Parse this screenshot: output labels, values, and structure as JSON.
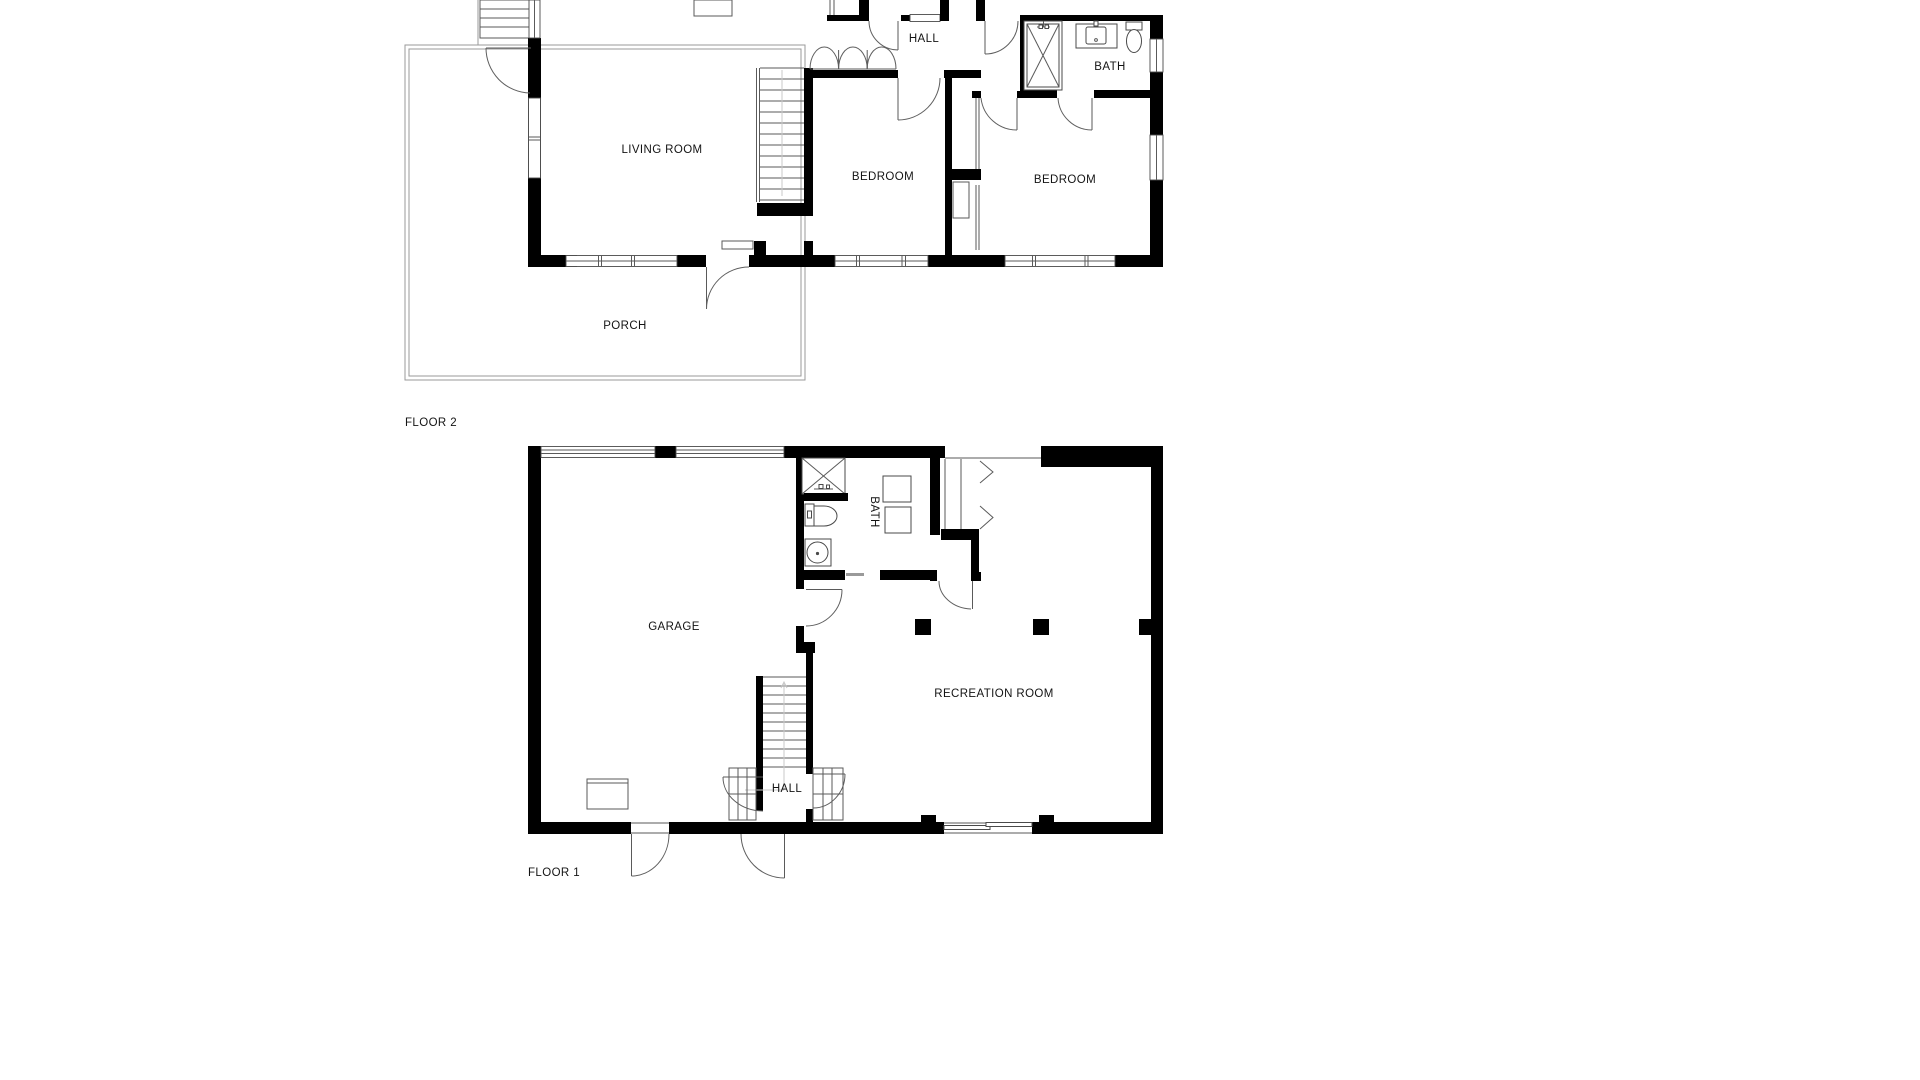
{
  "document": {
    "type": "floor-plan-drawing",
    "background_color": "#ffffff",
    "wall_color": "#000000",
    "line_color": "#5a5a5a",
    "text_color": "#141414"
  },
  "floor2": {
    "label": "FLOOR 2",
    "rooms": {
      "living_room": "LIVING ROOM",
      "hall": "HALL",
      "bath": "BATH",
      "bedroom_a": "BEDROOM",
      "bedroom_b": "BEDROOM",
      "porch": "PORCH"
    }
  },
  "floor1": {
    "label": "FLOOR 1",
    "rooms": {
      "garage": "GARAGE",
      "hall": "HALL",
      "bath": "BATH",
      "recreation_room": "RECREATION ROOM"
    }
  }
}
